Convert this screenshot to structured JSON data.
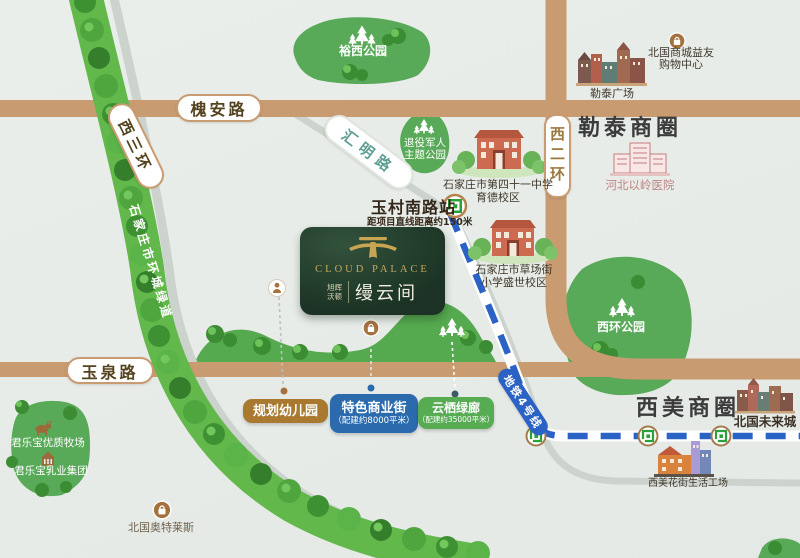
{
  "colors": {
    "road_tan": "#c89b71",
    "metro_blue": "#2b62c6",
    "park_green": "#58aa58",
    "belt_green": "#62b84a",
    "icon_brown": "#a5713e",
    "pill_brown": "#a9792f",
    "pill_blue": "#2a6aad",
    "pill_green": "#57ab53",
    "logo_gold": "#c8a552",
    "logo_bg": "#24402e",
    "hospital_rose": "#c47d7d"
  },
  "roads": {
    "huaian": "槐安路",
    "xisanhuan": "西三环",
    "huiming": "汇明路",
    "xierhuan": "西二环",
    "yuquan": "玉泉路",
    "greenway": "石家庄市环城绿道"
  },
  "metro": {
    "station_name": "玉村南路站",
    "station_distance": "距项目直线距离约150米",
    "line_label": "地铁4号线"
  },
  "project": {
    "logo_en": "CLOUD PALACE",
    "brand_line1": "旭辉",
    "brand_line2": "沃顿",
    "name_cn": "缦云间"
  },
  "districts": {
    "letai": "勒泰商圈",
    "ximei": "西美商圈"
  },
  "parks": {
    "yuxi": "裕西公园",
    "veterans_line1": "退役军人",
    "veterans_line2": "主题公园",
    "xihuan": "西环公园"
  },
  "pois": {
    "beiguo_mall_line1": "北国商城益友",
    "beiguo_mall_line2": "购物中心",
    "letai_plaza": "勒泰广场",
    "yiling_hospital": "河北以岭医院",
    "school41_line1": "石家庄市第四十一中学",
    "school41_line2": "育德校区",
    "caochang_line1": "石家庄市草场街",
    "caochang_line2": "小学盛世校区",
    "beiguo_future": "北国未来城",
    "ximei_flower": "西美花街生活工场",
    "junlebao_ranch": "君乐宝优质牧场",
    "junlebao_group": "君乐宝乳业集团",
    "beiguo_outlets": "北国奥特莱斯"
  },
  "planned": {
    "kindergarten_label": "规划幼儿园",
    "commercial_label": "特色商业街",
    "commercial_note": "（配建约8000平米）",
    "corridor_label": "云栖绿廊",
    "corridor_note": "（配建约35000平米）"
  }
}
